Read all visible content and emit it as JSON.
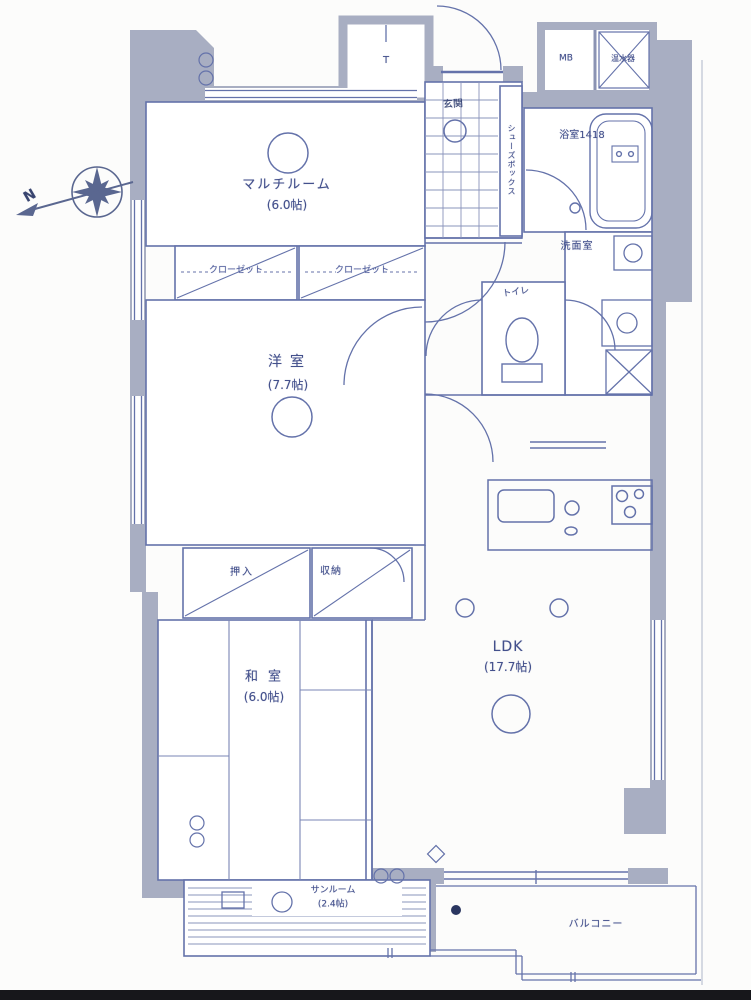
{
  "colors": {
    "line": "#6472aa",
    "wall": "#a8aec2",
    "background": "#fcfcfb",
    "text": "#43508c",
    "accent_dark": "#2a3660"
  },
  "compass": {
    "north_label": "N"
  },
  "rooms": {
    "multi_room": {
      "name": "マルチルーム",
      "size": "(6.0帖)"
    },
    "western_room": {
      "name": "洋室",
      "size": "(7.7帖)"
    },
    "japanese_room": {
      "name": "和室",
      "size": "(6.0帖)"
    },
    "ldk": {
      "name": "LDK",
      "size": "(17.7帖)"
    },
    "sunroom": {
      "name": "サンルーム",
      "size": "(2.4帖)"
    },
    "balcony": {
      "name": "バルコニー"
    },
    "entrance": {
      "name": "玄関"
    },
    "bathroom": {
      "name": "浴室1418"
    },
    "washroom": {
      "name": "洗面室"
    },
    "toilet": {
      "name": "トイレ"
    }
  },
  "storage": {
    "closet_left": "クローゼット",
    "closet_right": "クローゼット",
    "futon_closet": "押入",
    "storage_unit": "収納",
    "shoe_box": "シューズボックス",
    "trunk_room": "T",
    "meter_box": "MB",
    "water_heater": "温水器"
  }
}
